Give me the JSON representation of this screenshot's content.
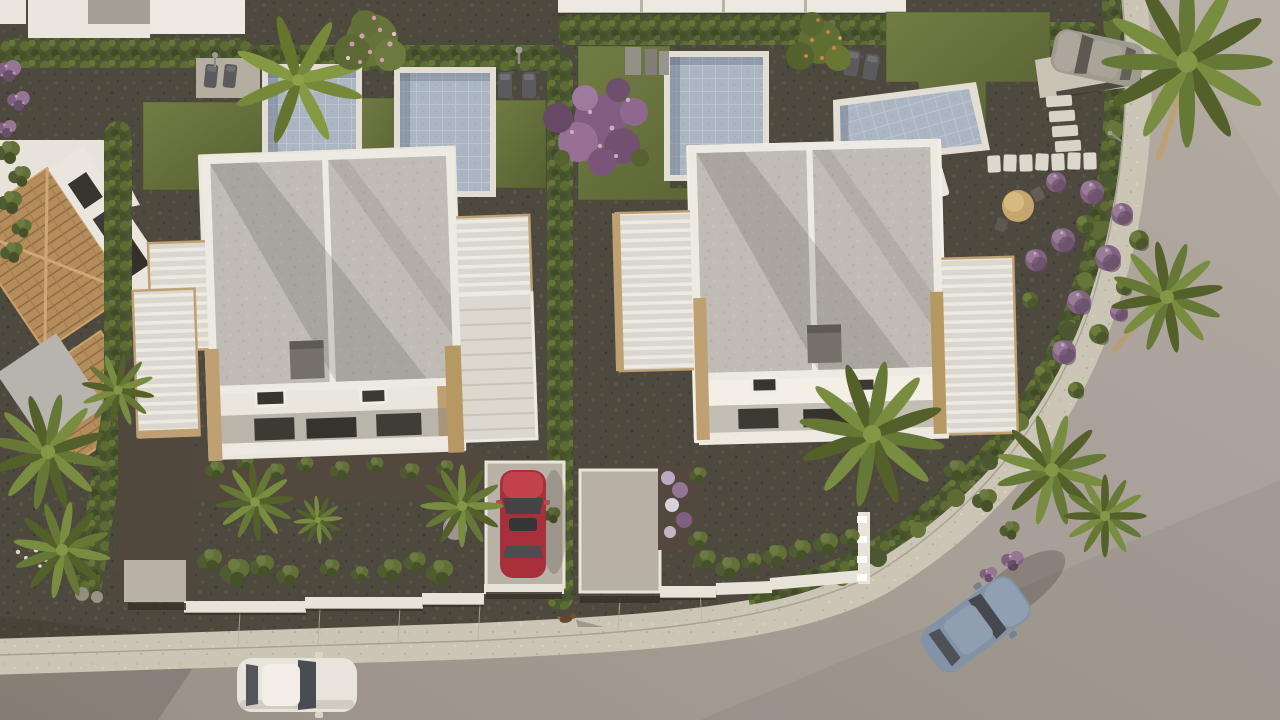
{
  "meta": {
    "title": "Aerial 3D render of a modern villa development at dusk",
    "width": 1280,
    "height": 720
  },
  "scene": {
    "description": "Top-down aerial architectural rendering: two semi-detached white villas with grey flat roofs and timber pergolas in the centre, four private pools along the top, landscaped gravel gardens with palms, hedges and purple bougainvillea, a terracotta-roofed house on the left, a curved road with sidewalk wrapping the right corner plot, a bottom road with a white car, a red car parked in a driveway, a blue car on the curved road, a silver car parked top-right, and a small dog on the sidewalk.",
    "objects": {
      "buildings": [
        "top-left-neighbour-roofs",
        "terracotta-house",
        "left-villa",
        "right-villa",
        "next-row-roof-band"
      ],
      "pools": [
        "neighbour-pool",
        "left-villa-pool",
        "right-villa-pool",
        "corner-plot-pool"
      ],
      "cars": [
        {
          "name": "white-car",
          "state": "driving on bottom road"
        },
        {
          "name": "red-car",
          "state": "parked in left villa driveway"
        },
        {
          "name": "blue-car",
          "state": "driving on curved road"
        },
        {
          "name": "silver-car",
          "state": "parked in top-right driveway"
        }
      ],
      "animal": {
        "name": "dog",
        "location": "sidewalk bottom centre"
      },
      "vegetation": [
        "banana-palm",
        "pink-flowering-tree",
        "purple-bougainvillea-tree",
        "orange-fruit-tree",
        "fan-palms",
        "box-hedges",
        "purple-ball-shrubs",
        "green-ball-shrubs"
      ],
      "furniture": [
        "sun-loungers",
        "pool-equipment-boxes",
        "outdoor-showers",
        "round-garden-table-set",
        "stepping-stones",
        "roof-ac-units",
        "garden-lamp"
      ]
    }
  },
  "colors": {
    "road": "#a39d97",
    "roadLight": "#b0aaa4",
    "roadDark": "#958f88",
    "sidewalk": "#c9c5b8",
    "gravel": "#454239",
    "lawnLight": "#6a7840",
    "lawnDark": "#4e5b2c",
    "hedge": "#43522c",
    "hedgeLight": "#56672f",
    "hedgeDark": "#333f20",
    "roof": "#bdbbb7",
    "ridge": "#edecE8",
    "wall": "#e9e7e1",
    "wallBright": "#f3f1ea",
    "wallShadow": "#99948a",
    "poolWater": "#a8b5c6",
    "poolRim": "#e2dfd7",
    "louvre": "#d9d7d2",
    "timber": "#bb9d71",
    "terracotta": "#b18a58",
    "soil": "#4a4138",
    "carWhite": "#e7e5e0",
    "carRed": "#a32836",
    "carBlue": "#7d90a8",
    "carSilver": "#9b978f",
    "glass": "#3d4248",
    "acUnit": "#6e6c66",
    "purpleBloom": "#7c5c80",
    "pinkBloom": "#cf9ab0",
    "palm": "#5e7331",
    "banana": "#6f8535",
    "orangeFruit": "#c8803c",
    "stone": "#dcd9d0",
    "trunk": "#b49a6e",
    "shadow": "#2a2620"
  }
}
